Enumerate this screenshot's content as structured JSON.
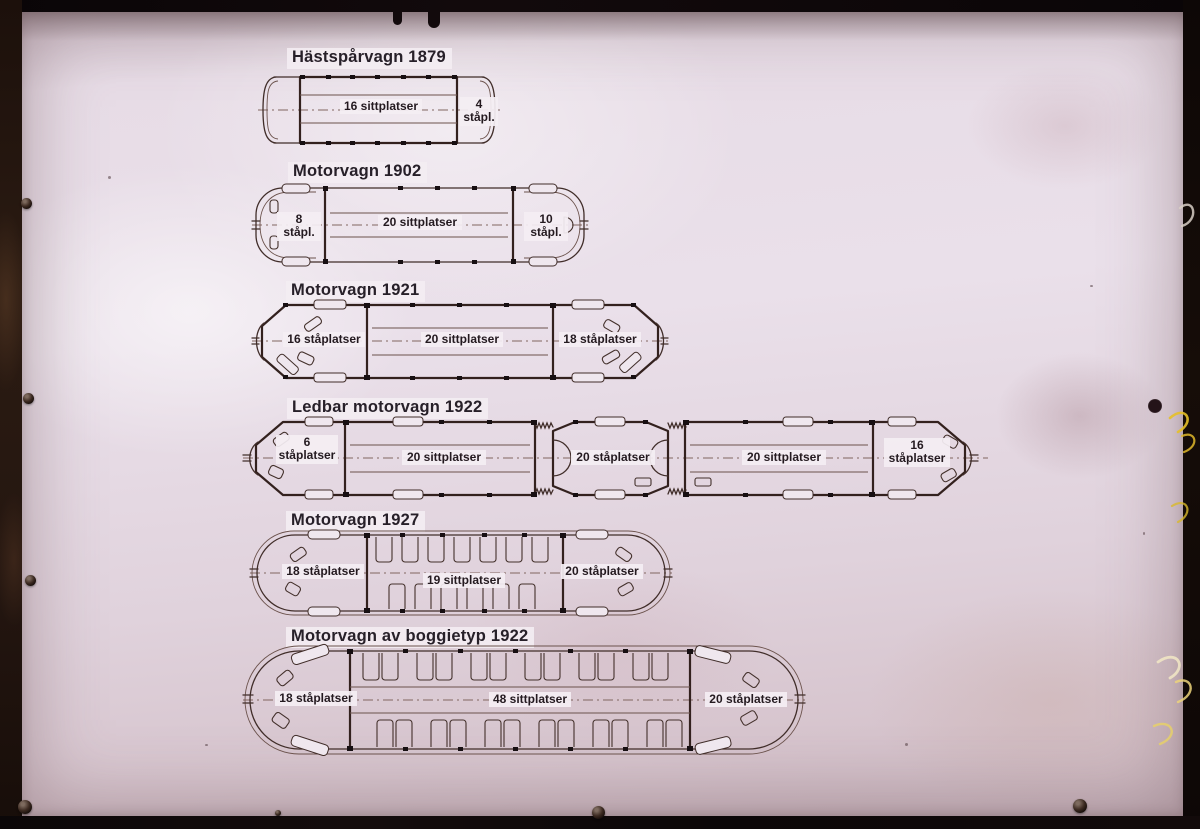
{
  "photo": {
    "paper_color": "#e3d7e2",
    "ink_color": "#3f2a26",
    "frame_color": "#0d0709",
    "scratch_color": "#e6c028"
  },
  "diagrams": [
    {
      "id": "hastsparvagn-1879",
      "title": "Hästspårvagn 1879",
      "labels": [
        "16 sittplatser",
        "4 ståpl."
      ]
    },
    {
      "id": "motorvagn-1902",
      "title": "Motorvagn 1902",
      "labels": [
        "8 ståpl.",
        "20 sittplatser",
        "10 ståpl."
      ]
    },
    {
      "id": "motorvagn-1921",
      "title": "Motorvagn 1921",
      "labels": [
        "16 ståplatser",
        "20 sittplatser",
        "18 ståplatser"
      ]
    },
    {
      "id": "ledbar-motorvagn-1922",
      "title": "Ledbar motorvagn 1922",
      "labels": [
        "6 ståplatser",
        "20 sittplatser",
        "20 ståplatser",
        "20 sittplatser",
        "16 ståplatser"
      ]
    },
    {
      "id": "motorvagn-1927",
      "title": "Motorvagn 1927",
      "labels": [
        "18 ståplatser",
        "19 sittplatser",
        "20 ståplatser"
      ]
    },
    {
      "id": "motorvagn-av-boggietyp-1922",
      "title": "Motorvagn av boggietyp 1922",
      "labels": [
        "18 ståplatser",
        "48 sittplatser",
        "20 ståplatser"
      ]
    }
  ]
}
